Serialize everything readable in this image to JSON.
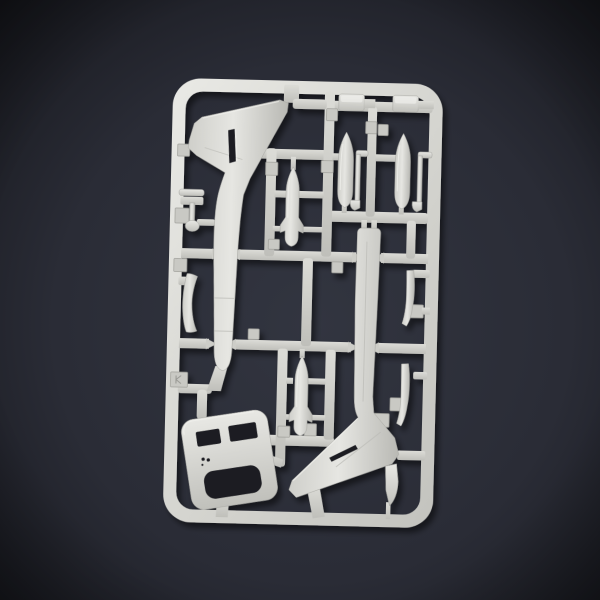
{
  "scene": {
    "type": "photograph",
    "description": "Photograph of a light-grey injection-moulded plastic model kit sprue (parts tree) for a small swept-wing jet aircraft, lying on dark blue-grey paper with a strong corner vignette.",
    "aria_label": "Plastic model kit sprue with aircraft parts on a dark background"
  },
  "palette": {
    "background_center": "#31343f",
    "background_edge": "#14151a",
    "plastic_light": "#ececе8",
    "plastic_base": "#c9c9c4",
    "plastic_shadow": "#b2b2ad",
    "hole_dark": "#1c1d24",
    "cast_shadow": "#000000"
  },
  "sprue": {
    "frame_shape": "rounded rectangle",
    "material": "light grey polystyrene",
    "tilt_degrees": 1.4,
    "parts": [
      {
        "id": "fuselage-half-left",
        "label": "Fuselage half with swept tail fin, nose down"
      },
      {
        "id": "fuselage-half-right",
        "label": "Fuselage half with swept tail fin, nose up"
      },
      {
        "id": "drop-tank-1",
        "label": "Drop tank"
      },
      {
        "id": "drop-tank-2",
        "label": "Drop tank"
      },
      {
        "id": "finned-store-upper",
        "label": "Finned underwing store"
      },
      {
        "id": "finned-store-lower",
        "label": "Finned underwing store"
      },
      {
        "id": "cutout-plate",
        "label": "Plate part with two slots and large opening"
      },
      {
        "id": "landing-gear-strut",
        "label": "Landing gear strut with wheel"
      },
      {
        "id": "gear-door-left",
        "label": "Curved gear door blade"
      },
      {
        "id": "gear-door-right-upper",
        "label": "Curved gear door blade"
      },
      {
        "id": "gear-door-right-lower",
        "label": "Curved gear door blade"
      },
      {
        "id": "fairing-block-1",
        "label": "Rectangular fairing block"
      },
      {
        "id": "fairing-block-2",
        "label": "Rectangular fairing block"
      },
      {
        "id": "pylon-hook-1",
        "label": "Pylon hook"
      },
      {
        "id": "pylon-hook-2",
        "label": "Pylon hook"
      },
      {
        "id": "rudder-tip",
        "label": "Rudder tip piece"
      }
    ],
    "number_tab_count": 17
  }
}
